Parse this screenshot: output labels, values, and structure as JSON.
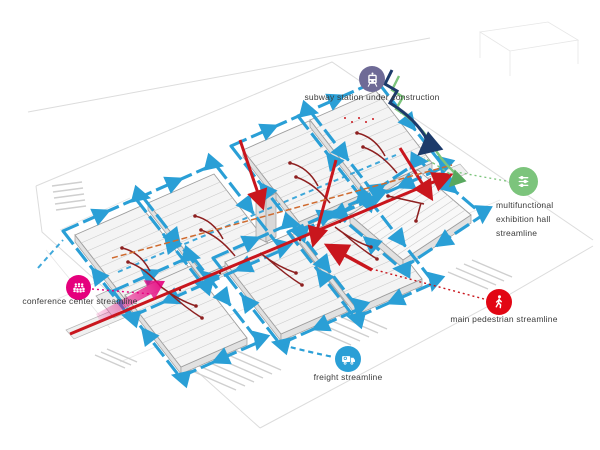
{
  "diagram_title": "exhibition complex circulation (streamline) diagram",
  "legend": {
    "subway": {
      "label": "subway station under construction",
      "icon": "train"
    },
    "exhibition": {
      "label": "multifunctional exhibition hall streamline",
      "line1": "multifunctional",
      "line2": "exhibition hall",
      "line3": "streamline",
      "icon": "sliders"
    },
    "pedestrian": {
      "label": "main pedestrian streamline",
      "icon": "walking-person"
    },
    "freight": {
      "label": "freight streamline",
      "icon": "truck"
    },
    "conference": {
      "label": "conference center streamline",
      "icon": "audience"
    }
  },
  "colors": {
    "freight": "#2a9fd6",
    "line_red": "#c9161d",
    "icon_red": "#e20613",
    "dark_red": "#8e2020",
    "orange": "#cf6a2e",
    "green": "#7cc47c",
    "green_arrow": "#58a85e",
    "navy": "#1c3a6a",
    "pink": "#e5007d",
    "purple": "#6e6a96",
    "road": "#dcdcdc",
    "building_fill": "#f4f4f4",
    "building_stroke": "#9d9d9d",
    "label": "#3c3c3c"
  }
}
